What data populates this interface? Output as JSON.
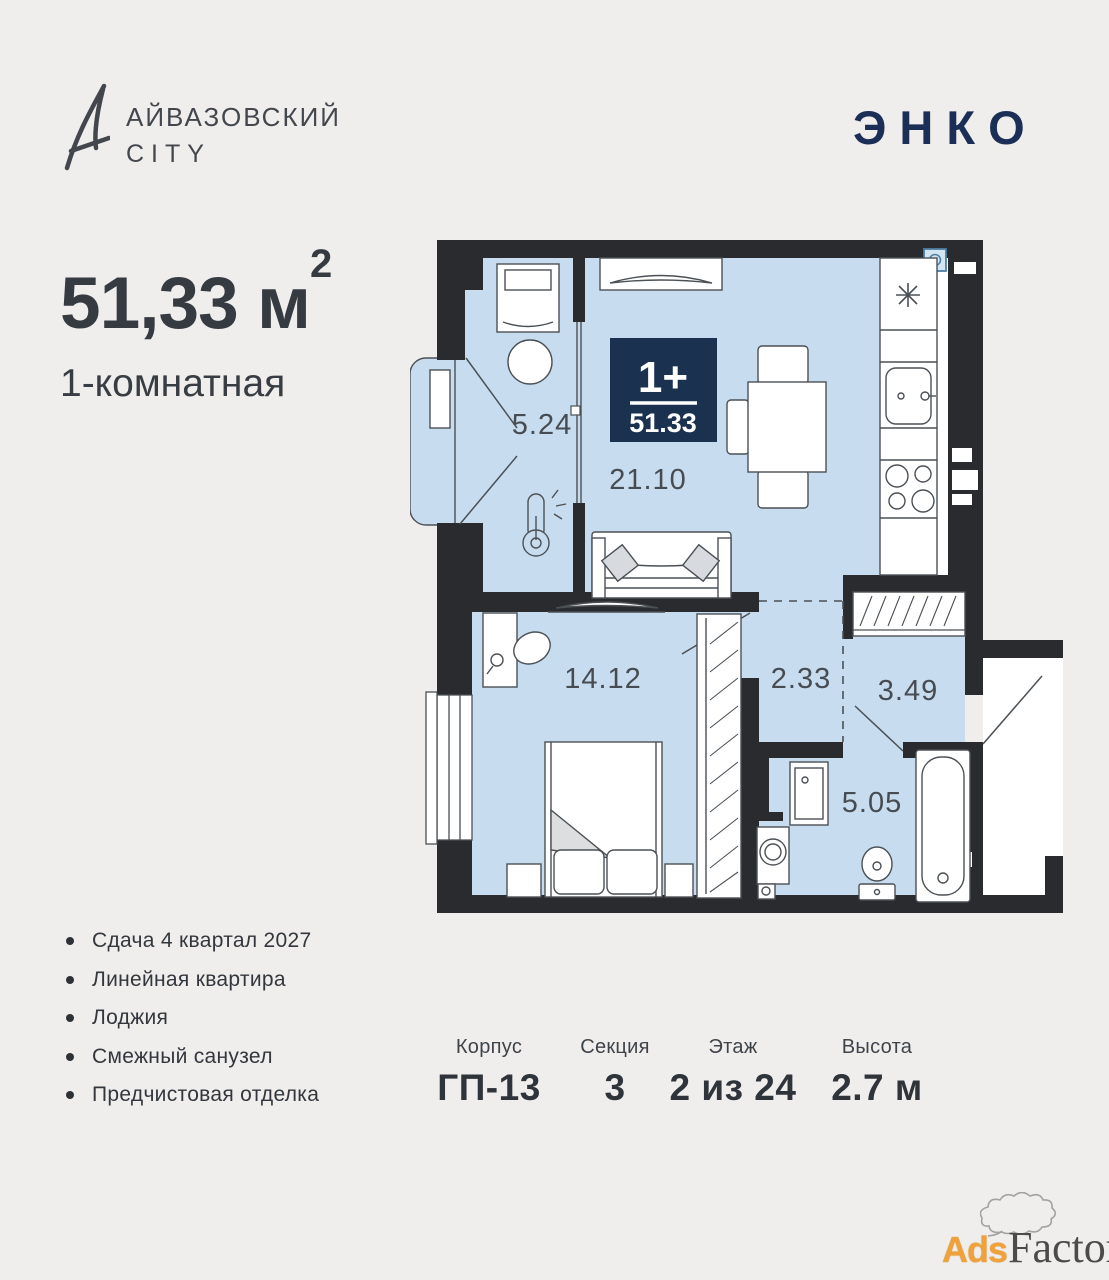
{
  "header": {
    "brand": {
      "glyph": "A",
      "line1": "АЙВАЗОВСКИЙ",
      "line2": "CITY"
    },
    "developer": {
      "name": "ЭНКО"
    }
  },
  "summary": {
    "area": "51,33",
    "area_unit": " м",
    "area_exp": "2",
    "type": "1-комнатная"
  },
  "plan": {
    "badge": {
      "rooms": "1+",
      "area": "51.33"
    },
    "rooms": [
      {
        "id": "loggia",
        "area": "5.24"
      },
      {
        "id": "kitchen-living",
        "area": "21.10"
      },
      {
        "id": "bedroom",
        "area": "14.12"
      },
      {
        "id": "hall",
        "area": "2.33"
      },
      {
        "id": "corridor",
        "area": "3.49"
      },
      {
        "id": "bathroom",
        "area": "5.05"
      }
    ]
  },
  "features": [
    "Сдача 4 квартал 2027",
    "Линейная квартира",
    "Лоджия",
    "Смежный санузел",
    "Предчистовая отделка"
  ],
  "details": [
    {
      "label": "Корпус",
      "value": "ГП-13"
    },
    {
      "label": "Секция",
      "value": "3"
    },
    {
      "label": "Этаж",
      "value": "2 из 24"
    },
    {
      "label": "Высота",
      "value": "2.7 м"
    }
  ],
  "watermark": {
    "part1": "Ads",
    "part2": "Factory"
  },
  "colors": {
    "background": "#efeeec",
    "accent_navy": "#1a3150",
    "floor_blue": "#c7dcee",
    "wall": "#2a2b2e",
    "text_dark": "#363b42",
    "watermark_orange": "#efa23b"
  }
}
